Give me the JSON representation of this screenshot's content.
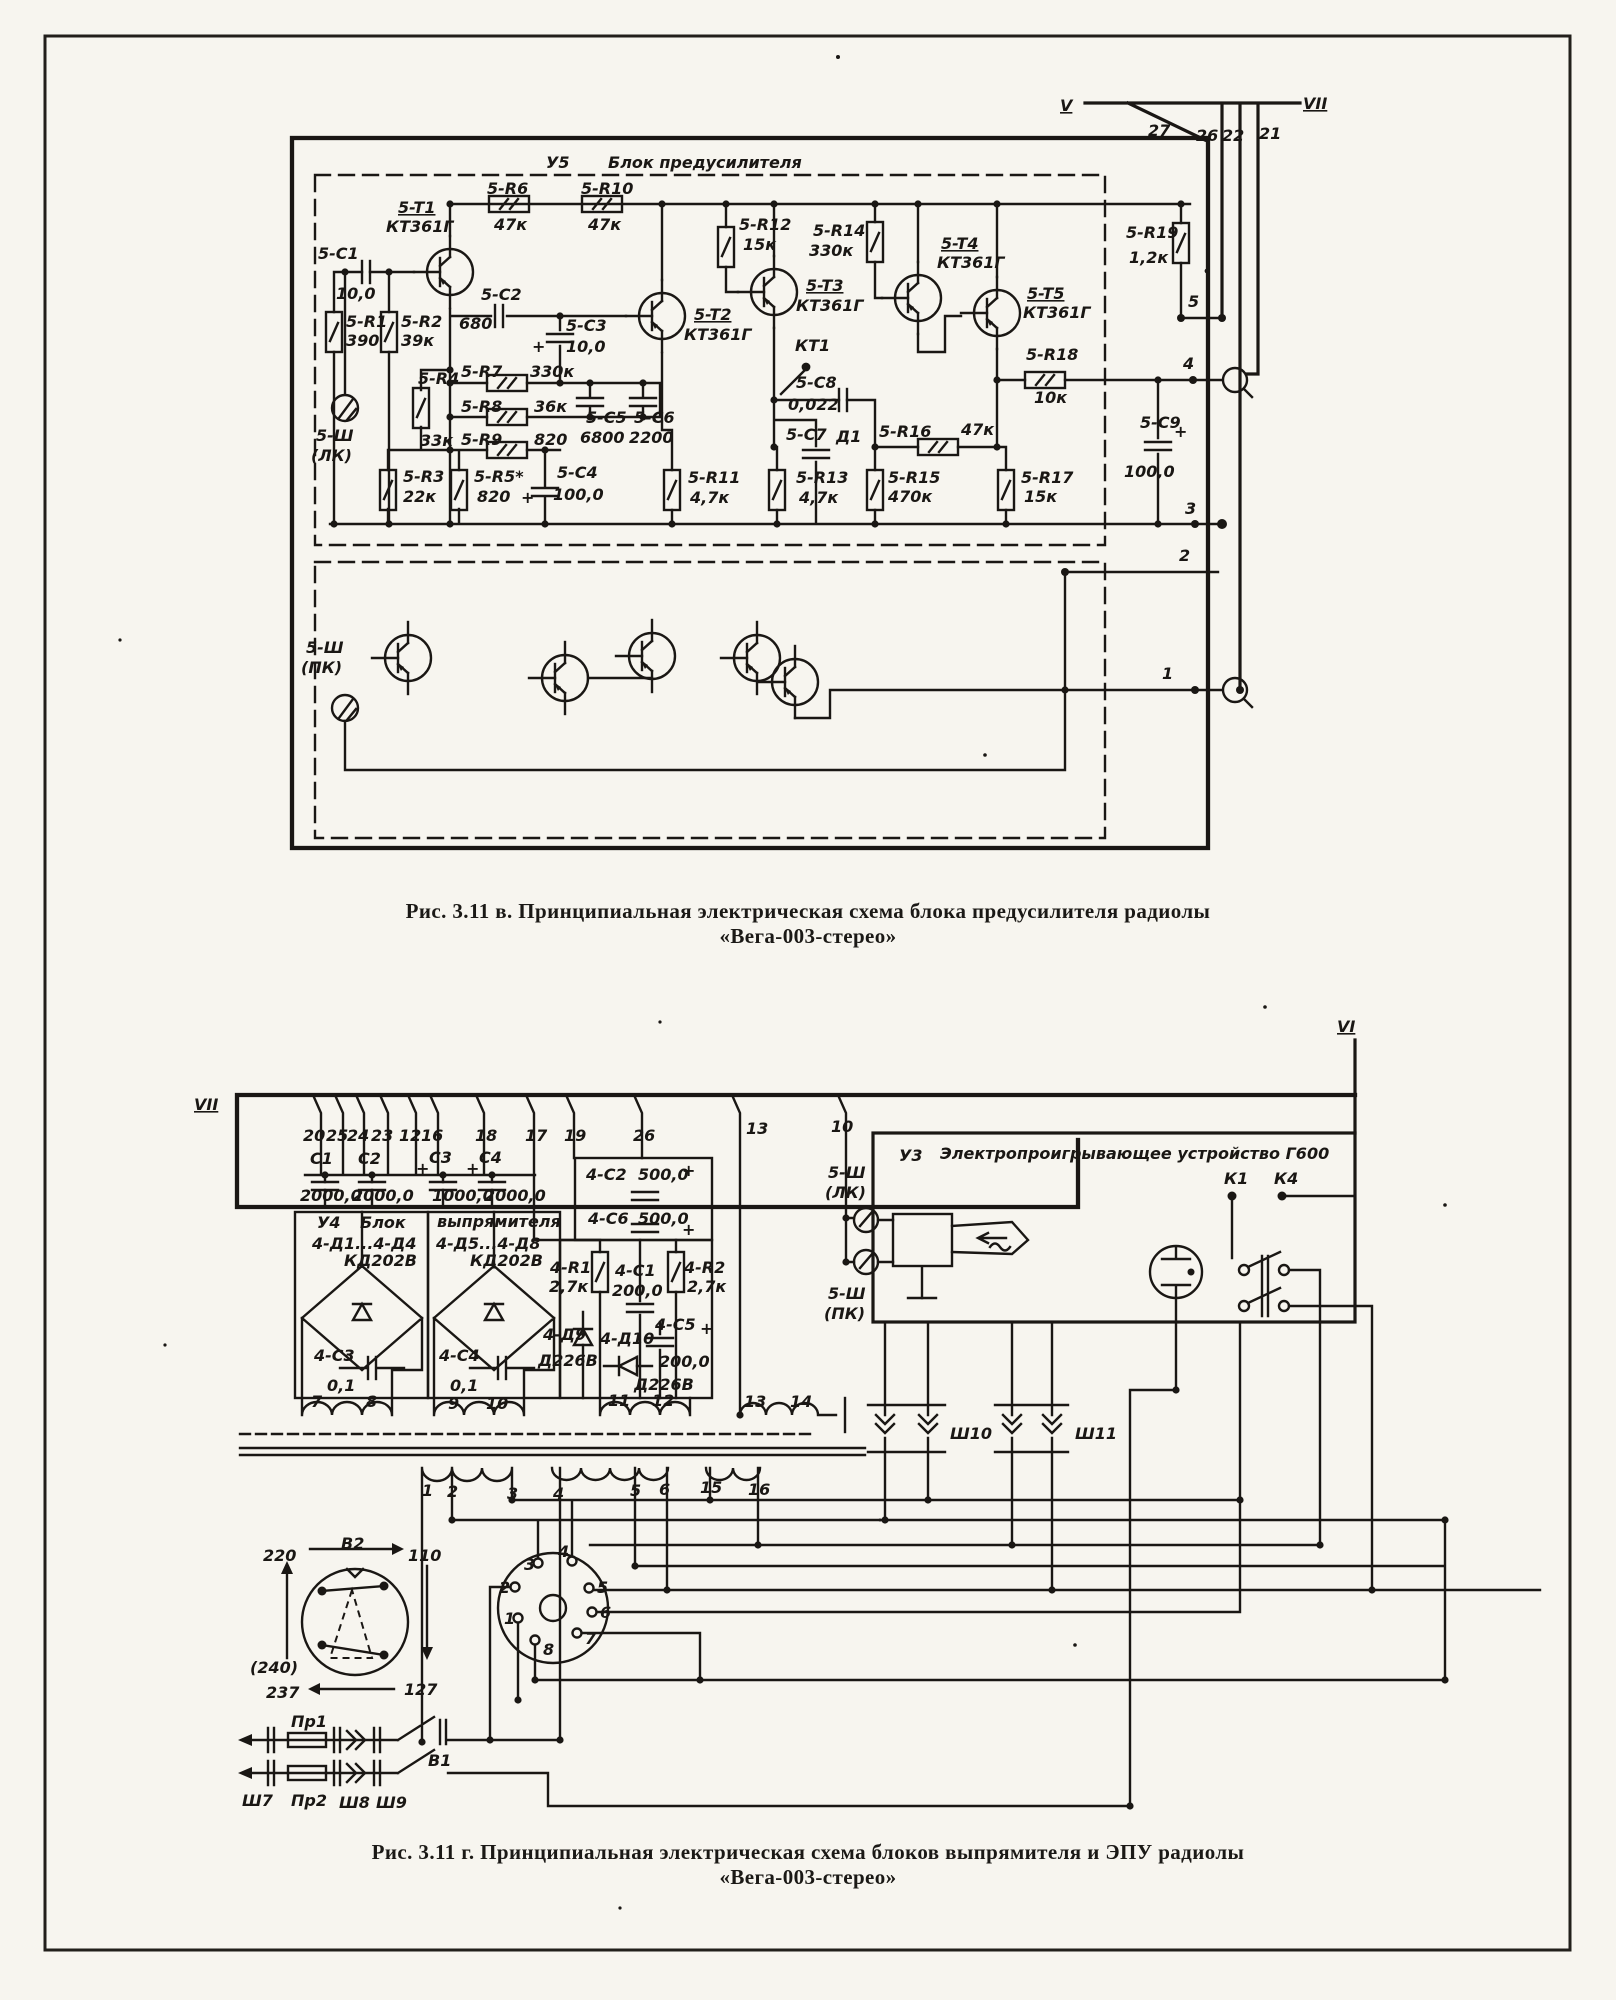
{
  "page": {
    "background": "#f7f5ef",
    "ink": "#1a1714"
  },
  "captions": {
    "fig_v": {
      "line1": "Рис. 3.11 в. Принципиальная электрическая схема блока предусилителя радиолы",
      "line2": "«Вега-003-стерео»"
    },
    "fig_g": {
      "line1": "Рис. 3.11 г. Принципиальная электрическая схема блоков выпрямителя и ЭПУ радиолы",
      "line2": "«Вега-003-стерео»"
    }
  },
  "figure_top": {
    "block_id": "У5",
    "block_name": "Блок предусилителя",
    "labels": [
      {
        "t": "У5",
        "x": 546,
        "y": 168,
        "s": 20
      },
      {
        "t": "Блок предусилителя",
        "x": 608,
        "y": 168,
        "s": 20
      },
      {
        "t": "5-T1",
        "x": 398,
        "y": 213,
        "u": 1
      },
      {
        "t": "КТ361Г",
        "x": 386,
        "y": 232
      },
      {
        "t": "5-R6",
        "x": 487,
        "y": 194
      },
      {
        "t": "47к",
        "x": 494,
        "y": 230
      },
      {
        "t": "5-R10",
        "x": 581,
        "y": 194
      },
      {
        "t": "47к",
        "x": 588,
        "y": 230
      },
      {
        "t": "5-C1",
        "x": 318,
        "y": 259
      },
      {
        "t": "10,0",
        "x": 336,
        "y": 299
      },
      {
        "t": "5-R1",
        "x": 346,
        "y": 327
      },
      {
        "t": "390",
        "x": 346,
        "y": 346
      },
      {
        "t": "5-R2",
        "x": 401,
        "y": 327
      },
      {
        "t": "39к",
        "x": 401,
        "y": 346
      },
      {
        "t": "5-C2",
        "x": 481,
        "y": 300
      },
      {
        "t": "680",
        "x": 459,
        "y": 329
      },
      {
        "t": "5-C3",
        "x": 566,
        "y": 331
      },
      {
        "t": "10,0",
        "x": 566,
        "y": 352
      },
      {
        "t": "+",
        "x": 532,
        "y": 352,
        "s": 22
      },
      {
        "t": "5-R4",
        "x": 418,
        "y": 384
      },
      {
        "t": "33к",
        "x": 420,
        "y": 446
      },
      {
        "t": "5-R7",
        "x": 461,
        "y": 377
      },
      {
        "t": "330к",
        "x": 530,
        "y": 377
      },
      {
        "t": "5-R8",
        "x": 461,
        "y": 412
      },
      {
        "t": "36к",
        "x": 534,
        "y": 412
      },
      {
        "t": "5-R9",
        "x": 461,
        "y": 445
      },
      {
        "t": "820",
        "x": 534,
        "y": 445
      },
      {
        "t": "5-C5",
        "x": 586,
        "y": 423
      },
      {
        "t": "6800",
        "x": 580,
        "y": 443
      },
      {
        "t": "5-C6",
        "x": 634,
        "y": 423
      },
      {
        "t": "2200",
        "x": 629,
        "y": 443
      },
      {
        "t": "5-Ш",
        "x": 316,
        "y": 441
      },
      {
        "t": "(ЛК)",
        "x": 311,
        "y": 461
      },
      {
        "t": "5-R3",
        "x": 403,
        "y": 482
      },
      {
        "t": "22к",
        "x": 403,
        "y": 502
      },
      {
        "t": "5-R5*",
        "x": 474,
        "y": 482
      },
      {
        "t": "820",
        "x": 477,
        "y": 502
      },
      {
        "t": "5-C4",
        "x": 557,
        "y": 478
      },
      {
        "t": "100,0",
        "x": 553,
        "y": 500
      },
      {
        "t": "+",
        "x": 521,
        "y": 503,
        "s": 22
      },
      {
        "t": "5-R11",
        "x": 688,
        "y": 483
      },
      {
        "t": "4,7к",
        "x": 690,
        "y": 503
      },
      {
        "t": "5-T2",
        "x": 694,
        "y": 320,
        "u": 1
      },
      {
        "t": "КТ361Г",
        "x": 684,
        "y": 340
      },
      {
        "t": "5-R12",
        "x": 739,
        "y": 230
      },
      {
        "t": "15к",
        "x": 743,
        "y": 250
      },
      {
        "t": "5-T3",
        "x": 806,
        "y": 291,
        "u": 1
      },
      {
        "t": "КТ361Г",
        "x": 796,
        "y": 311
      },
      {
        "t": "КТ1",
        "x": 795,
        "y": 351
      },
      {
        "t": "5-C8",
        "x": 796,
        "y": 388
      },
      {
        "t": "0,022",
        "x": 788,
        "y": 410
      },
      {
        "t": "5-C7",
        "x": 786,
        "y": 440
      },
      {
        "t": "Д1",
        "x": 836,
        "y": 442
      },
      {
        "t": "5-R13",
        "x": 796,
        "y": 483
      },
      {
        "t": "4,7к",
        "x": 799,
        "y": 503
      },
      {
        "t": "5-R14",
        "x": 813,
        "y": 236
      },
      {
        "t": "330к",
        "x": 809,
        "y": 256
      },
      {
        "t": "5-R16",
        "x": 879,
        "y": 437
      },
      {
        "t": "47к",
        "x": 961,
        "y": 435
      },
      {
        "t": "5-R15",
        "x": 888,
        "y": 483
      },
      {
        "t": "470к",
        "x": 888,
        "y": 502
      },
      {
        "t": "5-T4",
        "x": 941,
        "y": 249,
        "u": 1
      },
      {
        "t": "КТ361Г",
        "x": 937,
        "y": 268
      },
      {
        "t": "5-T5",
        "x": 1027,
        "y": 299,
        "u": 1
      },
      {
        "t": "КТ361Г",
        "x": 1023,
        "y": 318
      },
      {
        "t": "5-R18",
        "x": 1026,
        "y": 360
      },
      {
        "t": "10к",
        "x": 1034,
        "y": 403
      },
      {
        "t": "5-R17",
        "x": 1021,
        "y": 483
      },
      {
        "t": "15к",
        "x": 1024,
        "y": 502
      },
      {
        "t": "5-R19",
        "x": 1126,
        "y": 238
      },
      {
        "t": "1,2к",
        "x": 1129,
        "y": 263
      },
      {
        "t": "5-C9",
        "x": 1140,
        "y": 428
      },
      {
        "t": "+",
        "x": 1174,
        "y": 437,
        "s": 20
      },
      {
        "t": "100,0",
        "x": 1124,
        "y": 477
      },
      {
        "t": "5-Ш",
        "x": 306,
        "y": 653
      },
      {
        "t": "(ПК)",
        "x": 301,
        "y": 673
      },
      {
        "t": "V",
        "x": 1060,
        "y": 111,
        "u": 1,
        "s": 19
      },
      {
        "t": "VII",
        "x": 1303,
        "y": 109,
        "u": 1,
        "s": 19
      },
      {
        "t": "27",
        "x": 1148,
        "y": 136
      },
      {
        "t": "26",
        "x": 1196,
        "y": 141
      },
      {
        "t": "22",
        "x": 1222,
        "y": 141
      },
      {
        "t": "21",
        "x": 1259,
        "y": 139
      },
      {
        "t": "5",
        "x": 1188,
        "y": 307
      },
      {
        "t": "4",
        "x": 1183,
        "y": 369
      },
      {
        "t": "3",
        "x": 1185,
        "y": 514
      },
      {
        "t": "2",
        "x": 1179,
        "y": 561
      },
      {
        "t": "1",
        "x": 1162,
        "y": 679
      }
    ]
  },
  "figure_bottom": {
    "block_ids": {
      "rectifier": "У4",
      "epu": "У3"
    },
    "labels": [
      {
        "t": "VII",
        "x": 194,
        "y": 1110,
        "u": 1,
        "s": 19
      },
      {
        "t": "VI",
        "x": 1337,
        "y": 1032,
        "u": 1,
        "s": 19
      },
      {
        "t": "20",
        "x": 303,
        "y": 1141,
        "s": 14
      },
      {
        "t": "25",
        "x": 326,
        "y": 1141,
        "s": 14
      },
      {
        "t": "24",
        "x": 347,
        "y": 1141,
        "s": 14
      },
      {
        "t": "23",
        "x": 371,
        "y": 1141,
        "s": 14
      },
      {
        "t": "12",
        "x": 399,
        "y": 1141,
        "s": 14
      },
      {
        "t": "16",
        "x": 421,
        "y": 1141,
        "s": 14
      },
      {
        "t": "18",
        "x": 475,
        "y": 1141,
        "s": 14
      },
      {
        "t": "17",
        "x": 525,
        "y": 1141,
        "s": 14
      },
      {
        "t": "19",
        "x": 564,
        "y": 1141,
        "s": 14
      },
      {
        "t": "26",
        "x": 633,
        "y": 1141,
        "s": 14
      },
      {
        "t": "13",
        "x": 746,
        "y": 1134,
        "s": 14
      },
      {
        "t": "10",
        "x": 831,
        "y": 1132,
        "s": 14
      },
      {
        "t": "С1",
        "x": 310,
        "y": 1164
      },
      {
        "t": "С2",
        "x": 358,
        "y": 1164
      },
      {
        "t": "С3",
        "x": 429,
        "y": 1163
      },
      {
        "t": "С4",
        "x": 479,
        "y": 1163
      },
      {
        "t": "+",
        "x": 416,
        "y": 1174,
        "s": 15
      },
      {
        "t": "+",
        "x": 466,
        "y": 1174,
        "s": 15
      },
      {
        "t": "2000,0",
        "x": 300,
        "y": 1201,
        "s": 13
      },
      {
        "t": "2000,0",
        "x": 352,
        "y": 1201,
        "s": 13
      },
      {
        "t": "1000,0",
        "x": 432,
        "y": 1201,
        "s": 13
      },
      {
        "t": "2000,0",
        "x": 484,
        "y": 1201,
        "s": 13
      },
      {
        "t": "У4",
        "x": 317,
        "y": 1228
      },
      {
        "t": "Блок",
        "x": 360,
        "y": 1228
      },
      {
        "t": "выпрямителя",
        "x": 437,
        "y": 1227,
        "s": 15
      },
      {
        "t": "4-Д1...4-Д4",
        "x": 312,
        "y": 1249,
        "s": 14
      },
      {
        "t": "4-Д5...4-Д8",
        "x": 436,
        "y": 1249,
        "s": 14
      },
      {
        "t": "КД202В",
        "x": 344,
        "y": 1266,
        "s": 13
      },
      {
        "t": "КД202В",
        "x": 470,
        "y": 1266,
        "s": 13
      },
      {
        "t": "4-C3",
        "x": 314,
        "y": 1361,
        "s": 14
      },
      {
        "t": "0,1",
        "x": 327,
        "y": 1391,
        "s": 14
      },
      {
        "t": "4-C4",
        "x": 439,
        "y": 1361,
        "s": 14
      },
      {
        "t": "0,1",
        "x": 450,
        "y": 1391,
        "s": 14
      },
      {
        "t": "4-R1",
        "x": 550,
        "y": 1273,
        "s": 14
      },
      {
        "t": "2,7к",
        "x": 549,
        "y": 1292,
        "s": 14
      },
      {
        "t": "4-C1",
        "x": 615,
        "y": 1276,
        "s": 14
      },
      {
        "t": "200,0",
        "x": 612,
        "y": 1296,
        "s": 14
      },
      {
        "t": "4-R2",
        "x": 684,
        "y": 1273,
        "s": 14
      },
      {
        "t": "2,7к",
        "x": 687,
        "y": 1292,
        "s": 14
      },
      {
        "t": "4-C2",
        "x": 586,
        "y": 1180,
        "s": 14
      },
      {
        "t": "500,0",
        "x": 638,
        "y": 1180,
        "s": 14
      },
      {
        "t": "+",
        "x": 682,
        "y": 1176,
        "s": 18
      },
      {
        "t": "4-С6",
        "x": 588,
        "y": 1224,
        "s": 14
      },
      {
        "t": "500,0",
        "x": 638,
        "y": 1224,
        "s": 14
      },
      {
        "t": "+",
        "x": 682,
        "y": 1235,
        "s": 18
      },
      {
        "t": "4-Д9",
        "x": 543,
        "y": 1340,
        "s": 14
      },
      {
        "t": "Д226В",
        "x": 538,
        "y": 1366,
        "s": 13
      },
      {
        "t": "4-Д10",
        "x": 600,
        "y": 1344,
        "s": 14
      },
      {
        "t": "Д226В",
        "x": 634,
        "y": 1390,
        "s": 13
      },
      {
        "t": "4-С5",
        "x": 655,
        "y": 1330,
        "s": 14
      },
      {
        "t": "+",
        "x": 700,
        "y": 1334,
        "s": 18
      },
      {
        "t": "200,0",
        "x": 659,
        "y": 1367,
        "s": 13
      },
      {
        "t": "7",
        "x": 311,
        "y": 1407,
        "s": 14
      },
      {
        "t": "8",
        "x": 366,
        "y": 1407,
        "s": 14
      },
      {
        "t": "9",
        "x": 448,
        "y": 1409,
        "s": 14
      },
      {
        "t": "10",
        "x": 486,
        "y": 1409,
        "s": 14
      },
      {
        "t": "11",
        "x": 608,
        "y": 1406,
        "s": 14
      },
      {
        "t": "12",
        "x": 652,
        "y": 1406,
        "s": 14
      },
      {
        "t": "13",
        "x": 744,
        "y": 1407,
        "s": 14
      },
      {
        "t": "14",
        "x": 790,
        "y": 1407,
        "s": 14
      },
      {
        "t": "1",
        "x": 422,
        "y": 1496,
        "s": 14
      },
      {
        "t": "2",
        "x": 447,
        "y": 1497,
        "s": 14
      },
      {
        "t": "3",
        "x": 507,
        "y": 1499,
        "s": 14
      },
      {
        "t": "4",
        "x": 553,
        "y": 1499,
        "s": 14
      },
      {
        "t": "5",
        "x": 630,
        "y": 1496,
        "s": 14
      },
      {
        "t": "6",
        "x": 659,
        "y": 1495,
        "s": 14
      },
      {
        "t": "15",
        "x": 700,
        "y": 1493,
        "s": 14
      },
      {
        "t": "16",
        "x": 748,
        "y": 1495,
        "s": 14
      },
      {
        "t": "Ш10",
        "x": 950,
        "y": 1439
      },
      {
        "t": "Ш11",
        "x": 1075,
        "y": 1439
      },
      {
        "t": "У3",
        "x": 899,
        "y": 1161,
        "s": 19
      },
      {
        "t": "Электропроигрывающее устройство Г600",
        "x": 940,
        "y": 1159,
        "s": 17
      },
      {
        "t": "5-Ш",
        "x": 828,
        "y": 1178,
        "s": 15
      },
      {
        "t": "(ЛК)",
        "x": 825,
        "y": 1198,
        "s": 15
      },
      {
        "t": "5-Ш",
        "x": 828,
        "y": 1299,
        "s": 15
      },
      {
        "t": "(ПК)",
        "x": 824,
        "y": 1319,
        "s": 15
      },
      {
        "t": "К1",
        "x": 1224,
        "y": 1184
      },
      {
        "t": "К4",
        "x": 1274,
        "y": 1184
      },
      {
        "t": "В2",
        "x": 341,
        "y": 1549
      },
      {
        "t": "220",
        "x": 263,
        "y": 1561
      },
      {
        "t": "110",
        "x": 408,
        "y": 1561
      },
      {
        "t": "(240)",
        "x": 250,
        "y": 1673
      },
      {
        "t": "237",
        "x": 266,
        "y": 1698
      },
      {
        "t": "127",
        "x": 404,
        "y": 1695
      },
      {
        "t": "Пр1",
        "x": 291,
        "y": 1727,
        "s": 15
      },
      {
        "t": "Пр2",
        "x": 291,
        "y": 1806,
        "s": 15
      },
      {
        "t": "Ш7",
        "x": 242,
        "y": 1806,
        "s": 15
      },
      {
        "t": "Ш8",
        "x": 339,
        "y": 1808,
        "s": 15
      },
      {
        "t": "Ш9",
        "x": 376,
        "y": 1808,
        "s": 15
      },
      {
        "t": "В1",
        "x": 428,
        "y": 1766,
        "s": 15
      },
      {
        "t": "3",
        "x": 524,
        "y": 1570,
        "s": 13
      },
      {
        "t": "4",
        "x": 558,
        "y": 1557,
        "s": 13
      },
      {
        "t": "2",
        "x": 499,
        "y": 1593,
        "s": 13
      },
      {
        "t": "5",
        "x": 597,
        "y": 1593,
        "s": 13
      },
      {
        "t": "1",
        "x": 504,
        "y": 1624,
        "s": 13
      },
      {
        "t": "6",
        "x": 600,
        "y": 1618,
        "s": 13
      },
      {
        "t": "7",
        "x": 585,
        "y": 1644,
        "s": 13
      },
      {
        "t": "8",
        "x": 543,
        "y": 1655,
        "s": 13
      }
    ]
  }
}
